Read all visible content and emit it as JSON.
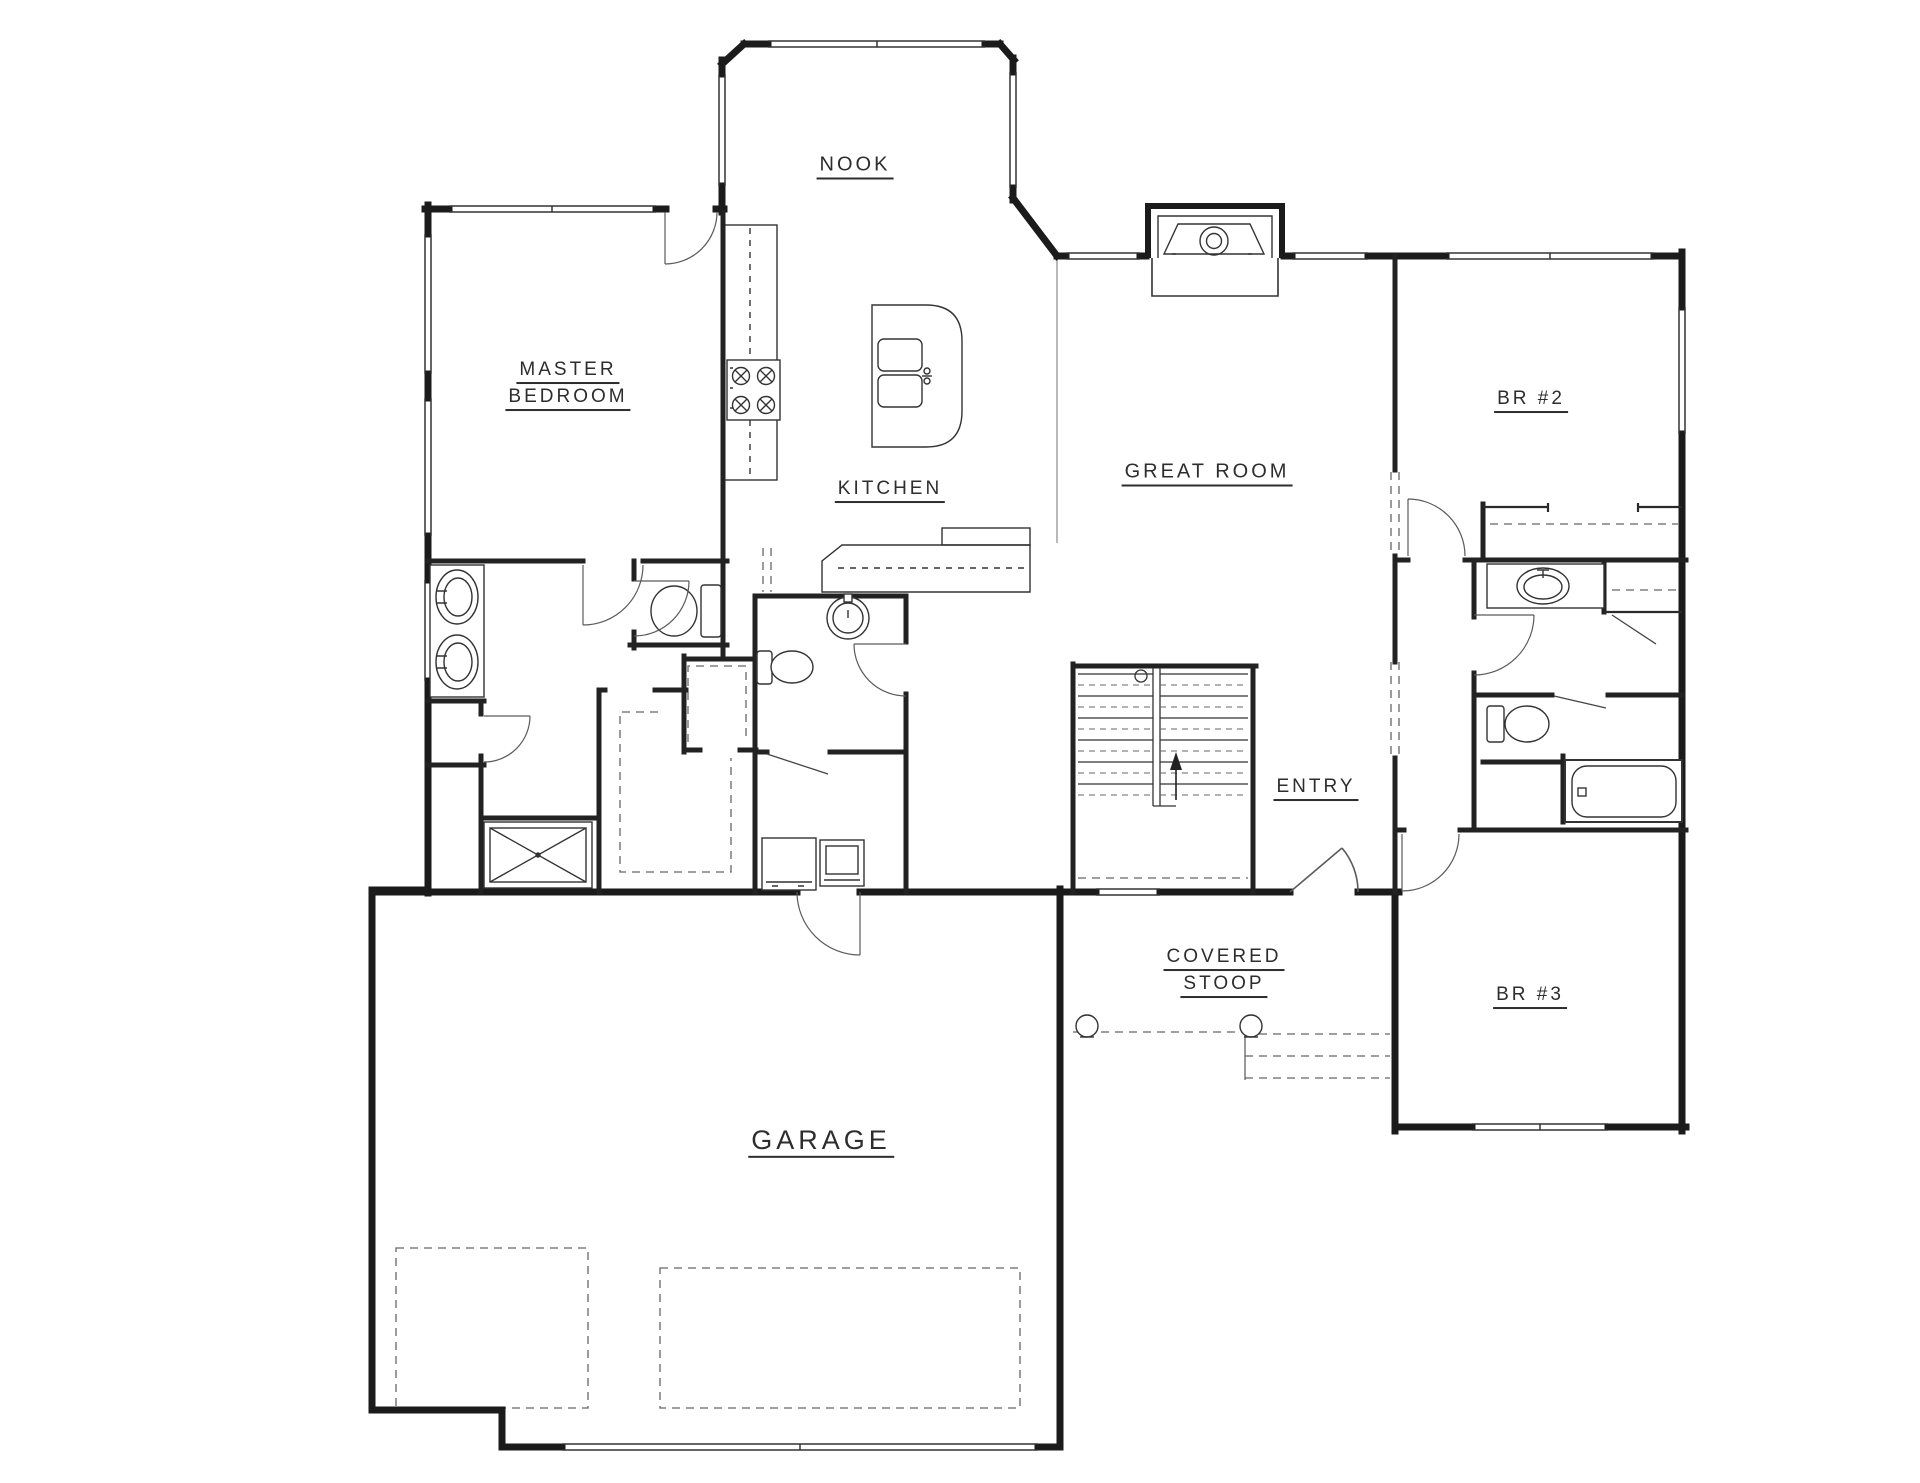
{
  "title": "Main floor plan",
  "colors": {
    "wall": "#1b1b1b",
    "interior_wall": "#222222",
    "fixture_line": "#333333",
    "door_line": "#5a5a5a",
    "dashed_line": "#666666",
    "label_text": "#2d2d2d",
    "background": "#ffffff"
  },
  "rooms": [
    {
      "id": "nook",
      "label": "NOOK",
      "x": 855,
      "y": 167,
      "size": 20
    },
    {
      "id": "master-bedroom-line1",
      "label": "MASTER",
      "x": 568,
      "y": 372,
      "size": 19
    },
    {
      "id": "master-bedroom-line2",
      "label": "BEDROOM",
      "x": 568,
      "y": 399,
      "size": 19
    },
    {
      "id": "kitchen",
      "label": "KITCHEN",
      "x": 890,
      "y": 491,
      "size": 19
    },
    {
      "id": "great-room",
      "label": "GREAT ROOM",
      "x": 1207,
      "y": 474,
      "size": 20
    },
    {
      "id": "br2",
      "label": "BR #2",
      "x": 1531,
      "y": 401,
      "size": 19
    },
    {
      "id": "entry",
      "label": "ENTRY",
      "x": 1316,
      "y": 789,
      "size": 19
    },
    {
      "id": "covered-stoop-line1",
      "label": "COVERED",
      "x": 1224,
      "y": 959,
      "size": 19
    },
    {
      "id": "covered-stoop-line2",
      "label": "STOOP",
      "x": 1224,
      "y": 986,
      "size": 19
    },
    {
      "id": "br3",
      "label": "BR #3",
      "x": 1530,
      "y": 997,
      "size": 19
    },
    {
      "id": "garage",
      "label": "GARAGE",
      "x": 821,
      "y": 1142,
      "size": 27
    }
  ],
  "fixtures": [
    "fireplace",
    "range-cooktop",
    "kitchen-island-double-sink",
    "kitchen-counter",
    "master-vanity-double-sink",
    "master-toilet",
    "shower",
    "walk-in-closet-shelves",
    "linen-closet",
    "pantry-shelves",
    "powder-pedestal-sink",
    "powder-toilet",
    "washer",
    "dryer",
    "staircase-up",
    "bath-vanity-sink",
    "bath-toilet",
    "bathtub",
    "stoop-columns",
    "stoop-steps",
    "garage-bay-outlines",
    "front-door",
    "garage-entry-door"
  ]
}
